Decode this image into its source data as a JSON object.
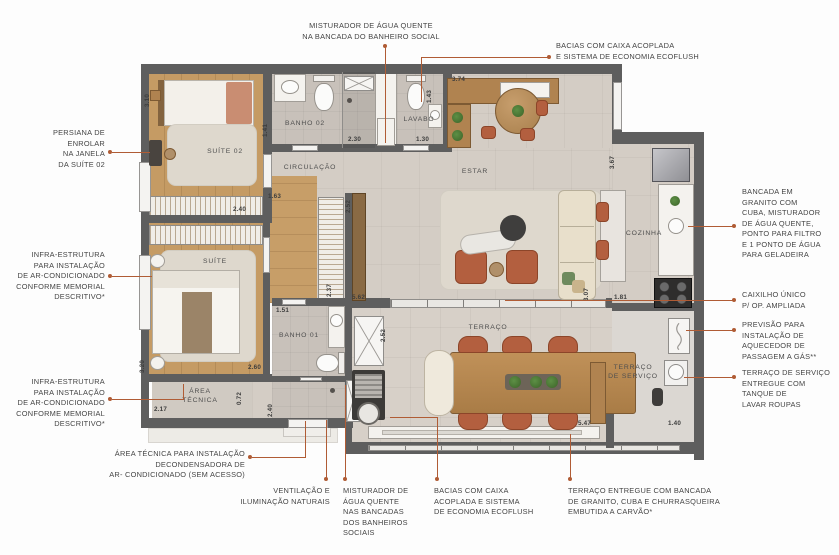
{
  "annotations": {
    "top": [
      "MISTURADOR DE ÁGUA QUENTE\nNA BANCADA DO BANHEIRO SOCIAL",
      "BACIAS COM CAIXA ACOPLADA\nE SISTEMA DE ECONOMIA ECOFLUSH"
    ],
    "left": [
      "PERSIANA DE\nENROLAR\nNA JANELA\nDA SUÍTE 02",
      "INFRA-ESTRUTURA\nPARA INSTALAÇÃO\nDE AR-CONDICIONADO\nCONFORME MEMORIAL\nDESCRITIVO*",
      "INFRA-ESTRUTURA\nPARA INSTALAÇÃO\nDE AR-CONDICIONADO\nCONFORME MEMORIAL\nDESCRITIVO*",
      "ÁREA TÉCNICA PARA INSTALAÇÃO\nDECONDENSADORA DE\nAR- CONDICIONADO (SEM ACESSO)"
    ],
    "right": [
      "BANCADA EM\nGRANITO COM\nCUBA, MISTURADOR\nDE ÁGUA QUENTE,\nPONTO PARA FILTRO\nE 1 PONTO DE ÁGUA\nPARA GELADEIRA",
      "CAIXILHO ÚNICO\nP/ OP. AMPLIADA",
      "PREVISÃO PARA\nINSTALAÇÃO DE\nAQUECEDOR DE\nPASSAGEM A GÁS**",
      "TERRAÇO DE SERVIÇO\nENTREGUE COM\nTANQUE DE\nLAVAR ROUPAS"
    ],
    "bottom": [
      "VENTILAÇÃO E\nILUMINAÇÃO NATURAIS",
      "MISTURADOR DE\nÁGUA QUENTE\nNAS BANCADAS\nDOS BANHEIROS\nSOCIAIS",
      "BACIAS COM CAIXA\nACOPLADA E SISTEMA\nDE ECONOMIA ECOFLUSH",
      "TERRAÇO ENTREGUE COM BANCADA\nDE GRANITO, CUBA E CHURRASQUEIRA\nEMBUTIDA A CARVÃO*"
    ]
  },
  "plan": {
    "rooms": {
      "suite02": "SUÍTE 02",
      "banho02": "BANHO 02",
      "lavabo": "LAVABO",
      "circulacao": "CIRCULAÇÃO",
      "estar": "ESTAR",
      "cozinha": "COZINHA",
      "suite": "SUÍTE",
      "banho01": "BANHO 01",
      "area_tecnica": "ÁREA\nTÉCNICA",
      "terraco": "TERRAÇO",
      "terraco_servico": "TERRAÇO\nDE SERVIÇO"
    },
    "dims": [
      "3.10",
      "2.40",
      "1.41",
      "2.30",
      "1.43",
      "1.30",
      "3.74",
      "1.63",
      "2.52",
      "2.37",
      "5.62",
      "3.07",
      "1.81",
      "3.67",
      "1.51",
      "2.60",
      "3.20",
      "2.17",
      "0.72",
      "2.40",
      "2.52",
      "5.47",
      "1.40"
    ]
  },
  "colors": {
    "leader": "#b05c35",
    "wall": "#5e5e5e",
    "floor": "#d4cdc5",
    "wood": "#c59b64",
    "chair_accent": "#b35f3f"
  }
}
